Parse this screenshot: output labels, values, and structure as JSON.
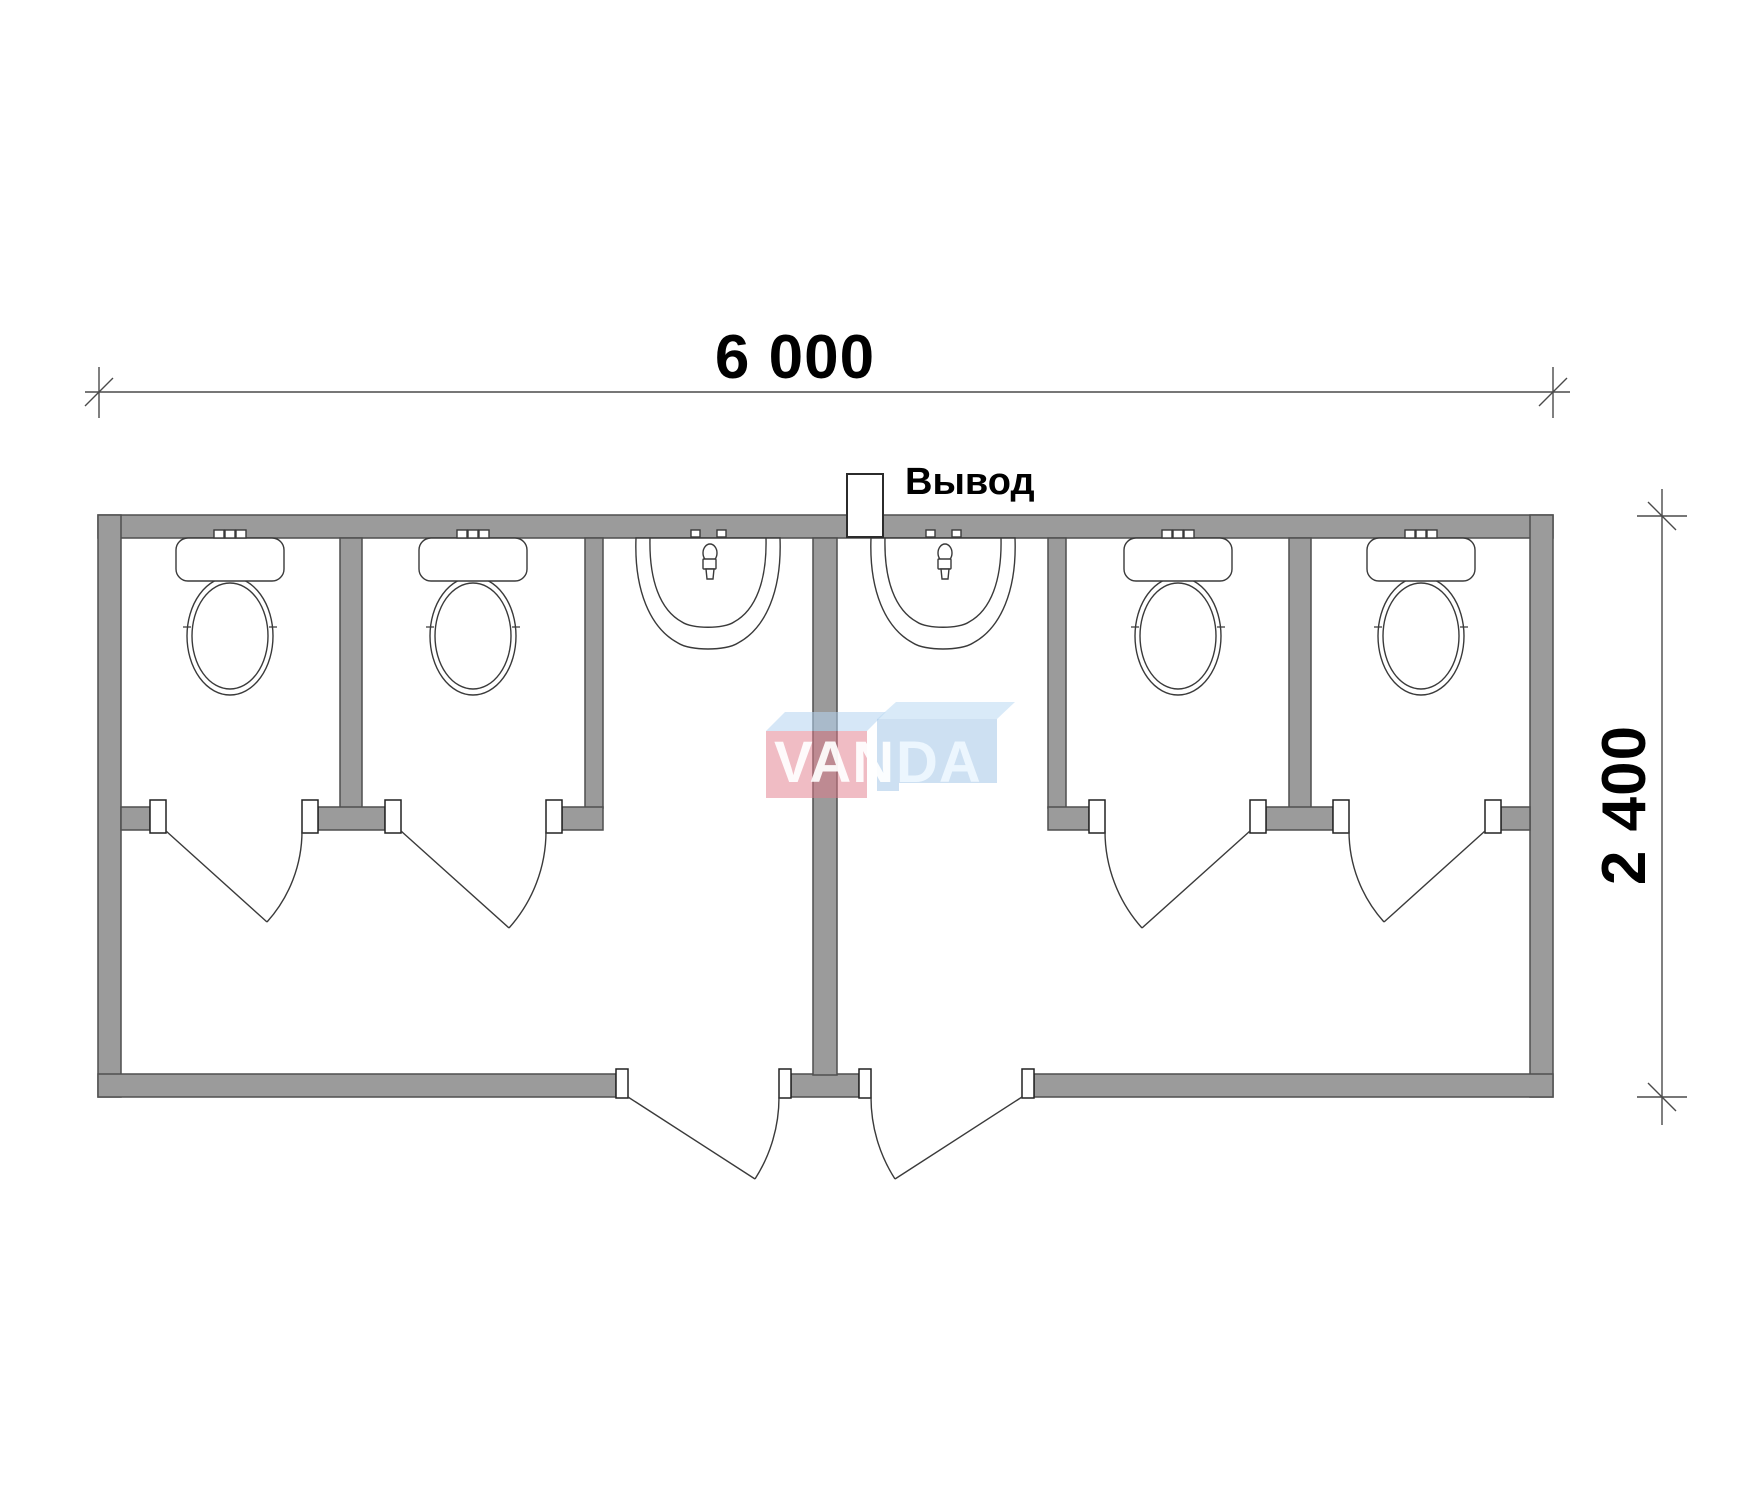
{
  "dimensions": {
    "width_label": "6 000",
    "height_label": "2 400"
  },
  "labels": {
    "outlet": "Вывод"
  },
  "watermark": {
    "text_left": "VAN",
    "text_right": "DA"
  },
  "colors": {
    "wall_fill": "#9b9b9b",
    "wall_stroke": "#4f4f4f",
    "fixture_stroke": "#3a3a3a",
    "dimension": "#4a4a4a",
    "watermark_pink": "rgba(225,121,137,0.5)",
    "watermark_blue": "rgba(155,193,229,0.5)",
    "watermark_top_face": "rgba(180,212,240,0.55)",
    "watermark_text": "#ffffff"
  },
  "plan": {
    "toilet_count": 4,
    "sink_count": 2,
    "stall_door_count": 4,
    "entrance_door_count": 2,
    "outlet_count": 1
  }
}
